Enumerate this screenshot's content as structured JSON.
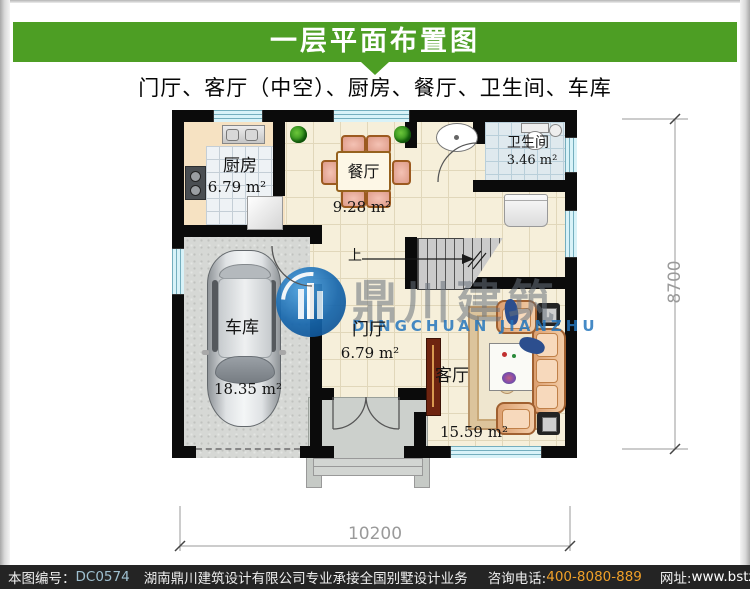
{
  "header": {
    "title": "一层平面布置图"
  },
  "subtitle": "门厅、客厅（中空）、厨房、餐厅、卫生间、车库",
  "plan": {
    "rooms": [
      {
        "name": "厨房",
        "area": "6.79 m²"
      },
      {
        "name": "餐厅",
        "area": "9.28 m²"
      },
      {
        "name": "卫生间",
        "area": "3.46 m²"
      },
      {
        "name": "车库",
        "area": "18.35 m²"
      },
      {
        "name": "门厅",
        "area": "6.79 m²"
      },
      {
        "name": "客厅",
        "area": "15.59 m²"
      }
    ],
    "stairs_up_label": "上",
    "dim_width": "10200",
    "dim_height": "8700"
  },
  "watermark": {
    "cn": "鼎川建筑",
    "en": "DINGCHUAN JIANZHU"
  },
  "footer": {
    "code_label": "本图编号：",
    "code": "DC0574",
    "company": "湖南鼎川建筑设计有限公司专业承接全国别墅设计业务",
    "phone_label": "咨询电话:",
    "phone": "400-8080-889",
    "website_label": "网址:",
    "website": "www.bstzcs.com"
  },
  "colors": {
    "header_green": "#4d9e24",
    "phone_orange": "#f0a028",
    "code_blue": "#9fc0d0",
    "watermark_blue": "#2b7cc0"
  }
}
